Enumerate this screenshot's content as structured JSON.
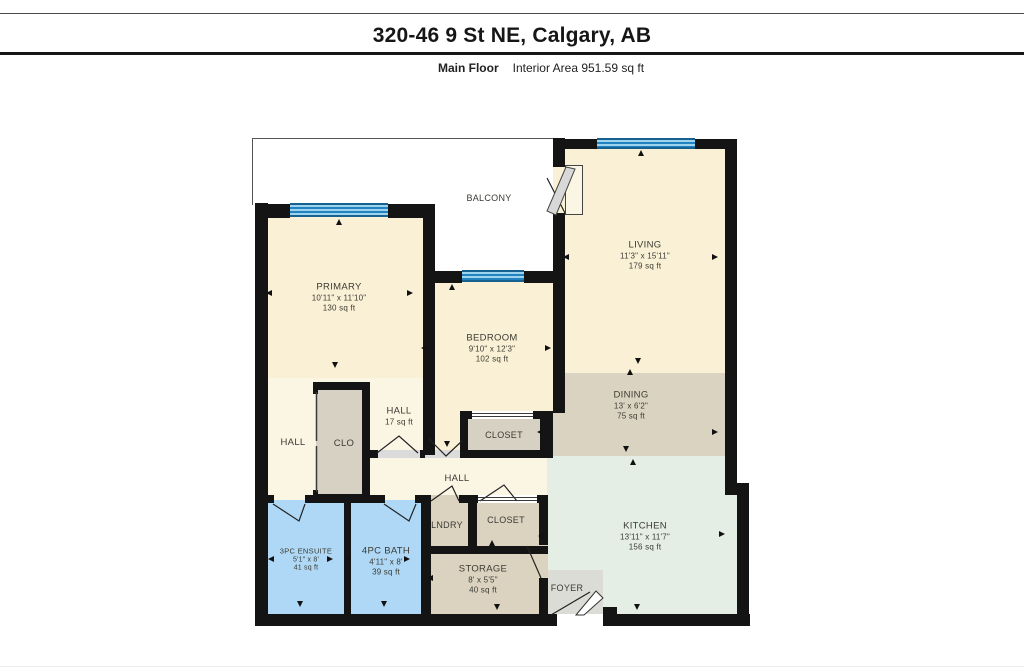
{
  "header": {
    "title": "320-46 9 St NE, Calgary, AB",
    "floor_label": "Main Floor",
    "area_label": "Interior Area 951.59 sq ft"
  },
  "rooms": {
    "balcony": {
      "name": "BALCONY"
    },
    "living": {
      "name": "LIVING",
      "dims": "11'3\" x 15'11\"",
      "area": "179 sq ft"
    },
    "primary": {
      "name": "PRIMARY",
      "dims": "10'11\" x 11'10\"",
      "area": "130 sq ft"
    },
    "bedroom": {
      "name": "BEDROOM",
      "dims": "9'10\" x 12'3\"",
      "area": "102 sq ft"
    },
    "dining": {
      "name": "DINING",
      "dims": "13' x 6'2\"",
      "area": "75 sq ft"
    },
    "kitchen": {
      "name": "KITCHEN",
      "dims": "13'11\" x 11'7\"",
      "area": "156 sq ft"
    },
    "hall_main": {
      "name": "HALL",
      "area": "17 sq ft"
    },
    "hall_left": {
      "name": "HALL"
    },
    "hall_lower": {
      "name": "HALL"
    },
    "clo": {
      "name": "CLO"
    },
    "bedroom_closet": {
      "name": "CLOSET"
    },
    "hall_closet": {
      "name": "CLOSET"
    },
    "laundry": {
      "name": "LNDRY"
    },
    "ensuite": {
      "name": "3PC ENSUITE",
      "dims": "5'1\" x 8'",
      "area": "41 sq ft"
    },
    "bath": {
      "name": "4PC BATH",
      "dims": "4'11\" x 8'",
      "area": "39 sq ft"
    },
    "storage": {
      "name": "STORAGE",
      "dims": "8' x 5'5\"",
      "area": "40 sq ft"
    },
    "foyer": {
      "name": "FOYER"
    }
  },
  "colors": {
    "wall": "#141414",
    "room_fill": "#FAF0D6",
    "hall_fill": "#FBF5E4",
    "dining_fill": "#DBD3C1",
    "closet_fill": "#D6D1C2",
    "kitchen_fill": "#E4EEE5",
    "bathroom_fill": "#AFD8F6",
    "window_blue": "#2383C0",
    "foyer_fill": "#DCDCD6"
  }
}
